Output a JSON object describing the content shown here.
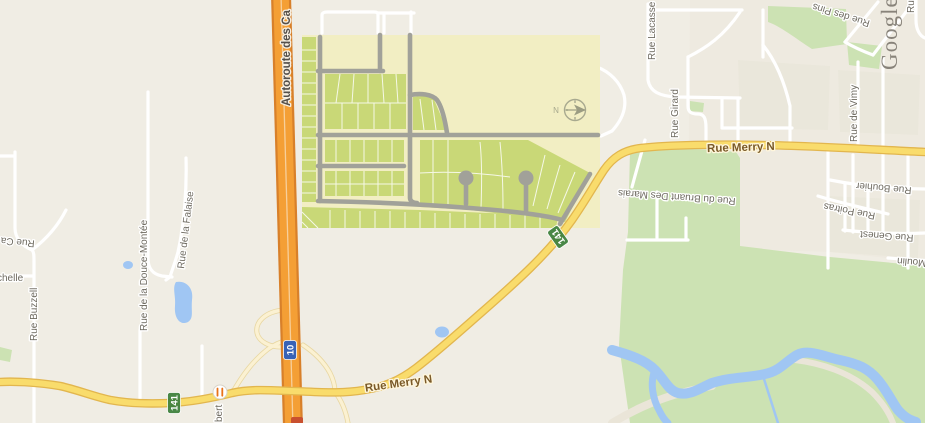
{
  "map": {
    "watermark": "Google",
    "labels": {
      "autoroute": "Autoroute des Ca",
      "merry_right": "Rue Merry N",
      "merry_bottom": "Rue Merry N",
      "lacasse": "Rue Lacasse",
      "girard": "Rue Girard",
      "des_pins": "Rue des Pins",
      "vimy": "Rue de Vimy",
      "bouhier": "Rue Bouhier",
      "poitras": "Rue Poitras",
      "genest": "Rue Genest",
      "moulin": "Moulin",
      "bruant": "Rue du Bruant Des Marais",
      "douce_montee": "Rue de la Douce-Montée",
      "falaise": "Rue de la Falaise",
      "buzzell": "Rue Buzzell",
      "ca_partial": "Rue Ca",
      "chelle_partial": "chelle",
      "bert_partial": "bert",
      "ru_partial": "Ru",
      "compass_n": "N"
    },
    "shields": {
      "route_141_east": "141",
      "route_141_west": "141",
      "autoroute_10": "10"
    },
    "icons": [
      "compass-icon",
      "restaurant-poi-icon"
    ],
    "colors": {
      "background": "#F0EDE4",
      "road_yellow": "#F9DC6C",
      "highway_orange": "#F49F35",
      "forest_green": "#CCE2B3",
      "water_blue": "#A0C6F3",
      "overlay_background": "#F2EEC3",
      "overlay_parcel_green": "#C9D877",
      "overlay_road_gray": "#A1A199",
      "shield_green": "#41823E",
      "shield_blue": "#2E5FBD"
    }
  }
}
